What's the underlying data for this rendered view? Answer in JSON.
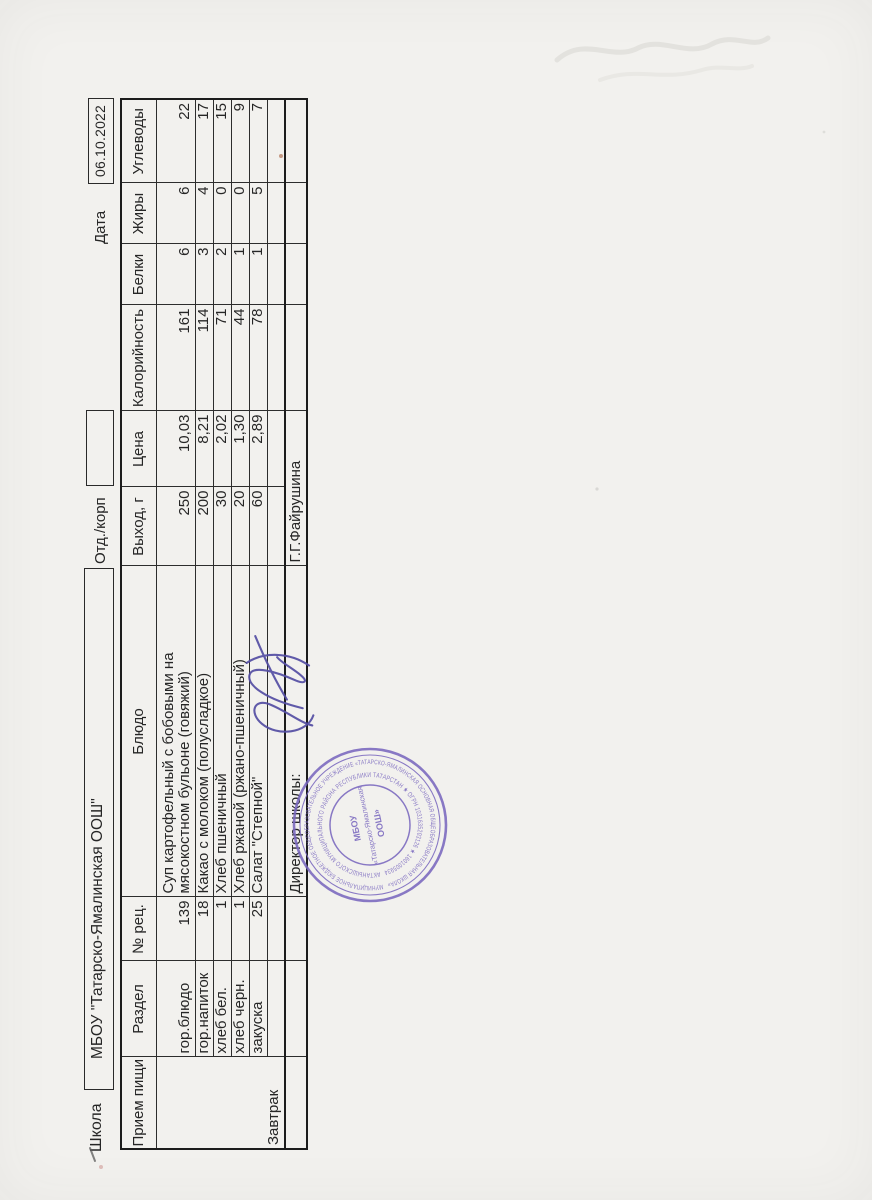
{
  "form": {
    "school_label": "Школа",
    "school_name": "МБОУ \"Татарско-Ямалинская ООШ\"",
    "dept_label": "Отд./корп",
    "dept_value": "",
    "date_label": "Дата",
    "date_value": "06.10.2022"
  },
  "table": {
    "headers": [
      "Прием пищи",
      "Раздел",
      "№ рец.",
      "Блюдо",
      "Выход, г",
      "Цена",
      "Калорийность",
      "Белки",
      "Жиры",
      "Углеводы"
    ],
    "meal": "Завтрак",
    "rows": [
      {
        "section": "гор.блюдо",
        "recipe_no": "139",
        "dish": "Суп картофельный с бобовыми на мясокостном бульоне (говяжий)",
        "output_g": "250",
        "price": "10,03",
        "kcal": "161",
        "protein": "6",
        "fat": "6",
        "carbs": "22"
      },
      {
        "section": "гор.напиток",
        "recipe_no": "18",
        "dish": "Какао с молоком (полусладкое)",
        "output_g": "200",
        "price": "8,21",
        "kcal": "114",
        "protein": "3",
        "fat": "4",
        "carbs": "17"
      },
      {
        "section": "хлеб бел.",
        "recipe_no": "1",
        "dish": "Хлеб пшеничный",
        "output_g": "30",
        "price": "2,02",
        "kcal": "71",
        "protein": "2",
        "fat": "0",
        "carbs": "15"
      },
      {
        "section": "хлеб черн.",
        "recipe_no": "1",
        "dish": "Хлеб ржаной (ржано-пшеничный)",
        "output_g": "20",
        "price": "1,30",
        "kcal": "44",
        "protein": "1",
        "fat": "0",
        "carbs": "9"
      },
      {
        "section": "закуска",
        "recipe_no": "25",
        "dish": "Салат \"Степной\"",
        "output_g": "60",
        "price": "2,89",
        "kcal": "78",
        "protein": "1",
        "fat": "5",
        "carbs": "7"
      }
    ]
  },
  "footer": {
    "director_label": "Директор школы:",
    "director_name": "Г.Г.Файрушина"
  },
  "stamp": {
    "ring_outer": "МУНИЦИПАЛЬНОЕ БЮДЖЕТНОЕ ОБЩЕОБРАЗОВАТЕЛЬНОЕ УЧРЕЖДЕНИЕ «ТАТАРСКО-ЯМАЛИНСКАЯ ОСНОВНАЯ ОБЩЕОБРАЗОВАТЕЛЬНАЯ ШКОЛА»",
    "ring_inner": "АКТАНЫШСКОГО МУНИЦИПАЛЬНОГО РАЙОНА РЕСПУБЛИКИ ТАТАРСТАН ★ ОГРН 1031635203126 ★ 1601005934",
    "center_line1": "МБОУ",
    "center_line2": "«Татарско-Ямалинская",
    "center_line3": "ООШ»"
  },
  "colors": {
    "paper": "#f2f1ee",
    "ink": "#262626",
    "table_border": "#1c1c1c",
    "stamp_purple": "#7a68bf",
    "signature_ink": "#544ea3"
  }
}
